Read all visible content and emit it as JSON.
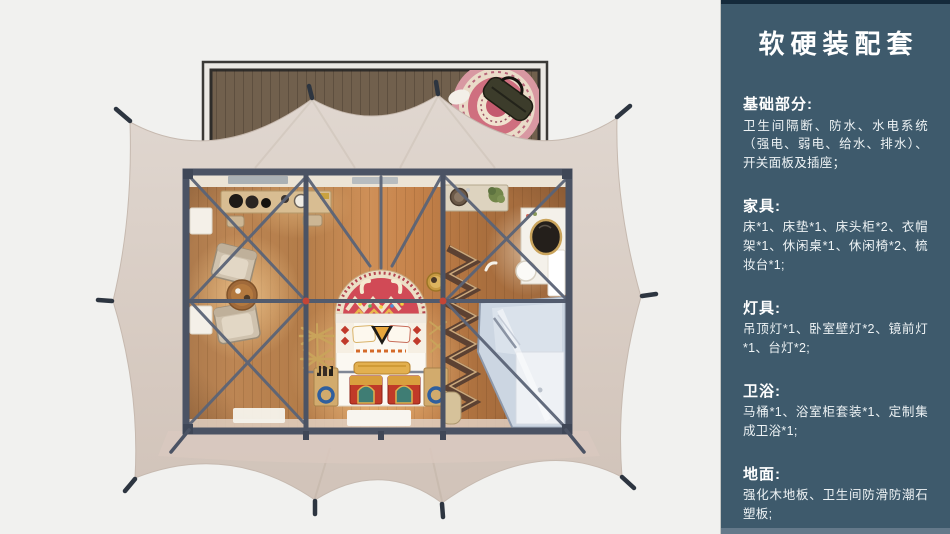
{
  "sidebar": {
    "title": "软硬装配套",
    "sections": [
      {
        "heading": "基础部分:",
        "body": "卫生间隔断、防水、水电系统（强电、弱电、给水、排水）、开关面板及插座；"
      },
      {
        "heading": "家具:",
        "body": "床*1、床垫*1、床头柜*2、衣帽架*1、休闲桌*1、休闲椅*2、梳妆台*1;"
      },
      {
        "heading": "灯具:",
        "body": "吊顶灯*1、卧室壁灯*2、镜前灯*1、台灯*2;"
      },
      {
        "heading": "卫浴:",
        "body": "马桶*1、浴室柜套装*1、定制集成卫浴*1;"
      },
      {
        "heading": "地面:",
        "body": "强化木地板、卫生间防滑防潮石塑板;"
      }
    ]
  },
  "colors": {
    "page_bg": "#f1f1ef",
    "sidebar_bg": "#3e5a6c",
    "sidebar_top_strip": "#152a3b",
    "sidebar_bottom_strip": "#64798a",
    "tent_canvas": "#d8ccc3",
    "steel_frame": "#4b5364",
    "wood_floor": "#c08a55",
    "deck_wood": "#71604d",
    "rug_red": "#d14a56",
    "chest_red": "#c03a28",
    "shower_glass": "#ccd6e2",
    "connector_red": "#c44536"
  }
}
